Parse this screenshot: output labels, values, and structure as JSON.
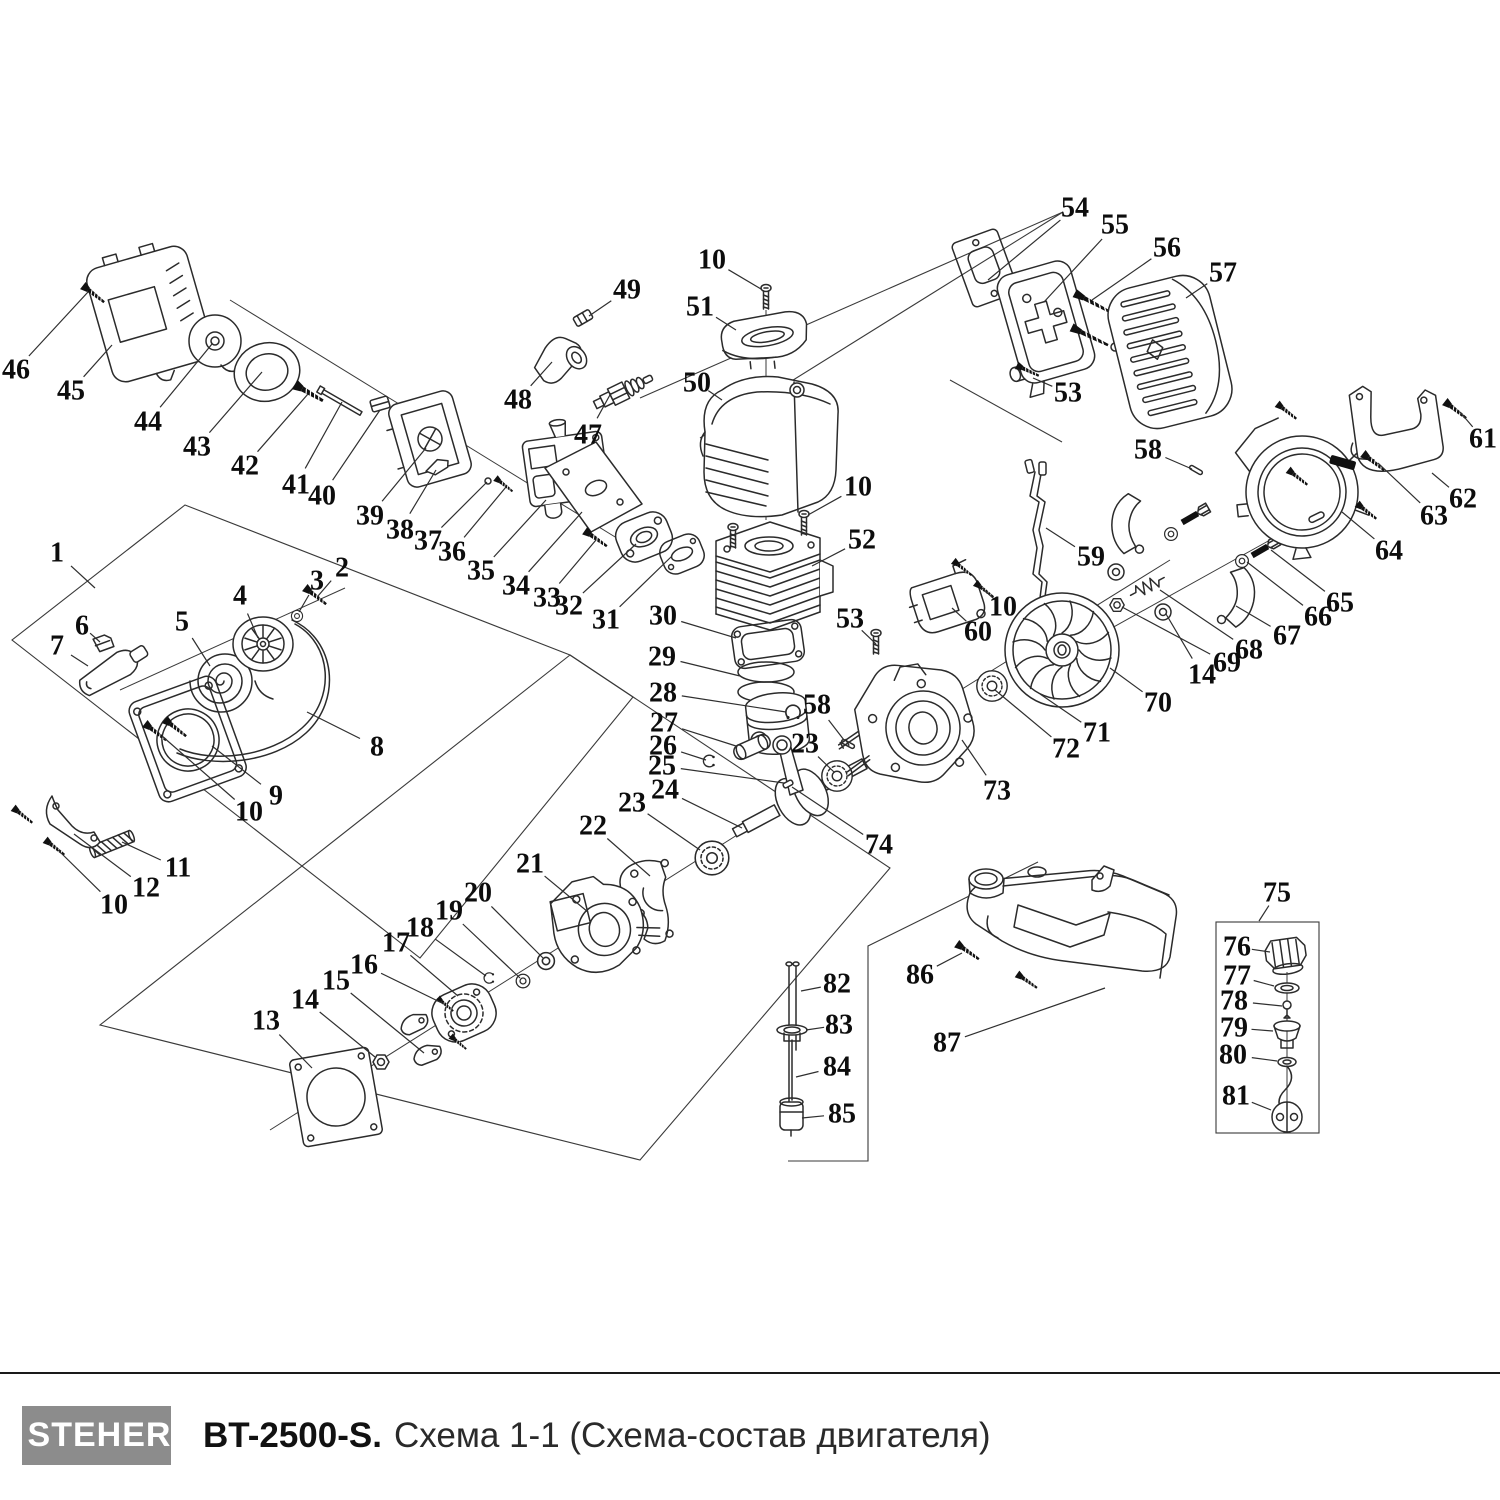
{
  "footer": {
    "brand": "STEHER",
    "model": "BT-2500-S.",
    "subtitle": "Схема 1-1 (Схема-состав двигателя)"
  },
  "colors": {
    "line_art": "#2b2b2b",
    "label_text": "#0d0d0d",
    "logo_background": "#8c8c8c",
    "footer_rule": "#1a1a1a",
    "background": "#ffffff"
  },
  "diagram": {
    "labels": [
      {
        "n": "1",
        "x": 57,
        "y": 553,
        "lx": 95,
        "ly": 588
      },
      {
        "n": "2",
        "x": 342,
        "y": 568,
        "lx": 318,
        "ly": 596
      },
      {
        "n": "3",
        "x": 317,
        "y": 581,
        "lx": 299,
        "ly": 612
      },
      {
        "n": "4",
        "x": 240,
        "y": 596,
        "lx": 258,
        "ly": 638
      },
      {
        "n": "5",
        "x": 182,
        "y": 622,
        "lx": 210,
        "ly": 666
      },
      {
        "n": "6",
        "x": 82,
        "y": 626,
        "lx": 100,
        "ly": 642
      },
      {
        "n": "7",
        "x": 57,
        "y": 646,
        "lx": 88,
        "ly": 666
      },
      {
        "n": "8",
        "x": 377,
        "y": 747,
        "lx": 307,
        "ly": 712
      },
      {
        "n": "9",
        "x": 276,
        "y": 796,
        "lx": 212,
        "ly": 746
      },
      {
        "n": "10",
        "x": 249,
        "y": 812,
        "lx": 162,
        "ly": 736
      },
      {
        "n": "11",
        "x": 178,
        "y": 868,
        "lx": 122,
        "ly": 842
      },
      {
        "n": "12",
        "x": 146,
        "y": 888,
        "lx": 74,
        "ly": 834
      },
      {
        "n": "10",
        "x": 114,
        "y": 905,
        "lx": 58,
        "ly": 850
      },
      {
        "n": "13",
        "x": 266,
        "y": 1021,
        "lx": 312,
        "ly": 1068
      },
      {
        "n": "14",
        "x": 305,
        "y": 1000,
        "lx": 375,
        "ly": 1057
      },
      {
        "n": "15",
        "x": 336,
        "y": 981,
        "lx": 424,
        "ly": 1053
      },
      {
        "n": "16",
        "x": 364,
        "y": 965,
        "lx": 444,
        "ly": 1004
      },
      {
        "n": "17",
        "x": 396,
        "y": 943,
        "lx": 458,
        "ly": 996
      },
      {
        "n": "18",
        "x": 420,
        "y": 928,
        "lx": 486,
        "ly": 976
      },
      {
        "n": "19",
        "x": 449,
        "y": 911,
        "lx": 520,
        "ly": 978
      },
      {
        "n": "20",
        "x": 478,
        "y": 893,
        "lx": 543,
        "ly": 958
      },
      {
        "n": "21",
        "x": 530,
        "y": 864,
        "lx": 588,
        "ly": 912
      },
      {
        "n": "22",
        "x": 593,
        "y": 826,
        "lx": 650,
        "ly": 876
      },
      {
        "n": "23",
        "x": 632,
        "y": 803,
        "lx": 700,
        "ly": 850
      },
      {
        "n": "24",
        "x": 665,
        "y": 790,
        "lx": 742,
        "ly": 828
      },
      {
        "n": "25",
        "x": 662,
        "y": 766,
        "lx": 784,
        "ly": 783
      },
      {
        "n": "26",
        "x": 663,
        "y": 746,
        "lx": 706,
        "ly": 760
      },
      {
        "n": "27",
        "x": 664,
        "y": 723,
        "lx": 736,
        "ly": 746
      },
      {
        "n": "28",
        "x": 663,
        "y": 693,
        "lx": 786,
        "ly": 712
      },
      {
        "n": "29",
        "x": 662,
        "y": 657,
        "lx": 740,
        "ly": 676
      },
      {
        "n": "30",
        "x": 663,
        "y": 616,
        "lx": 736,
        "ly": 638
      },
      {
        "n": "31",
        "x": 606,
        "y": 620,
        "lx": 672,
        "ly": 556
      },
      {
        "n": "32",
        "x": 569,
        "y": 606,
        "lx": 636,
        "ly": 544
      },
      {
        "n": "33",
        "x": 547,
        "y": 598,
        "lx": 596,
        "ly": 540
      },
      {
        "n": "34",
        "x": 516,
        "y": 586,
        "lx": 582,
        "ly": 512
      },
      {
        "n": "35",
        "x": 481,
        "y": 571,
        "lx": 546,
        "ly": 500
      },
      {
        "n": "36",
        "x": 452,
        "y": 552,
        "lx": 506,
        "ly": 487
      },
      {
        "n": "37",
        "x": 428,
        "y": 541,
        "lx": 487,
        "ly": 482
      },
      {
        "n": "38",
        "x": 400,
        "y": 530,
        "lx": 436,
        "ly": 470
      },
      {
        "n": "39",
        "x": 370,
        "y": 516,
        "lx": 426,
        "ly": 448
      },
      {
        "n": "40",
        "x": 322,
        "y": 496,
        "lx": 380,
        "ly": 410
      },
      {
        "n": "41",
        "x": 296,
        "y": 485,
        "lx": 342,
        "ly": 402
      },
      {
        "n": "42",
        "x": 245,
        "y": 466,
        "lx": 308,
        "ly": 394
      },
      {
        "n": "43",
        "x": 197,
        "y": 447,
        "lx": 262,
        "ly": 372
      },
      {
        "n": "44",
        "x": 148,
        "y": 422,
        "lx": 212,
        "ly": 344
      },
      {
        "n": "45",
        "x": 71,
        "y": 391,
        "lx": 112,
        "ly": 345
      },
      {
        "n": "46",
        "x": 16,
        "y": 370,
        "lx": 88,
        "ly": 292
      },
      {
        "n": "47",
        "x": 588,
        "y": 435,
        "lx": 611,
        "ly": 393
      },
      {
        "n": "48",
        "x": 518,
        "y": 400,
        "lx": 552,
        "ly": 362
      },
      {
        "n": "49",
        "x": 627,
        "y": 290,
        "lx": 589,
        "ly": 316
      },
      {
        "n": "50",
        "x": 697,
        "y": 383,
        "lx": 722,
        "ly": 400
      },
      {
        "n": "51",
        "x": 700,
        "y": 307,
        "lx": 736,
        "ly": 330
      },
      {
        "n": "10",
        "x": 712,
        "y": 260,
        "lx": 761,
        "ly": 289
      },
      {
        "n": "10",
        "x": 858,
        "y": 487,
        "lx": 808,
        "ly": 515
      },
      {
        "n": "52",
        "x": 862,
        "y": 540,
        "lx": 812,
        "ly": 566
      },
      {
        "n": "53",
        "x": 850,
        "y": 619,
        "lx": 876,
        "ly": 644
      },
      {
        "n": "53",
        "x": 1068,
        "y": 393,
        "lx": 1033,
        "ly": 378
      },
      {
        "n": "54",
        "x": 1075,
        "y": 208,
        "lx": 988,
        "ly": 280
      },
      {
        "n": "55",
        "x": 1115,
        "y": 225,
        "lx": 1044,
        "ly": 302
      },
      {
        "n": "56",
        "x": 1167,
        "y": 248,
        "lx": 1092,
        "ly": 300
      },
      {
        "n": "57",
        "x": 1223,
        "y": 273,
        "lx": 1186,
        "ly": 298
      },
      {
        "n": "58",
        "x": 1148,
        "y": 450,
        "lx": 1192,
        "ly": 469
      },
      {
        "n": "58",
        "x": 817,
        "y": 705,
        "lx": 844,
        "ly": 740
      },
      {
        "n": "59",
        "x": 1091,
        "y": 557,
        "lx": 1046,
        "ly": 528
      },
      {
        "n": "60",
        "x": 978,
        "y": 632,
        "lx": 952,
        "ly": 608
      },
      {
        "n": "10",
        "x": 1003,
        "y": 607,
        "lx": 982,
        "ly": 588
      },
      {
        "n": "61",
        "x": 1483,
        "y": 439,
        "lx": 1460,
        "ly": 412
      },
      {
        "n": "62",
        "x": 1463,
        "y": 499,
        "lx": 1432,
        "ly": 473
      },
      {
        "n": "63",
        "x": 1434,
        "y": 516,
        "lx": 1378,
        "ly": 463
      },
      {
        "n": "64",
        "x": 1389,
        "y": 551,
        "lx": 1342,
        "ly": 512
      },
      {
        "n": "65",
        "x": 1340,
        "y": 603,
        "lx": 1271,
        "ly": 550
      },
      {
        "n": "66",
        "x": 1318,
        "y": 617,
        "lx": 1247,
        "ly": 562
      },
      {
        "n": "67",
        "x": 1287,
        "y": 636,
        "lx": 1236,
        "ly": 606
      },
      {
        "n": "68",
        "x": 1249,
        "y": 650,
        "lx": 1160,
        "ly": 590
      },
      {
        "n": "69",
        "x": 1227,
        "y": 663,
        "lx": 1122,
        "ly": 607
      },
      {
        "n": "14",
        "x": 1202,
        "y": 675,
        "lx": 1166,
        "ly": 614
      },
      {
        "n": "70",
        "x": 1158,
        "y": 703,
        "lx": 1110,
        "ly": 668
      },
      {
        "n": "71",
        "x": 1097,
        "y": 733,
        "lx": 1040,
        "ly": 694
      },
      {
        "n": "72",
        "x": 1066,
        "y": 749,
        "lx": 995,
        "ly": 690
      },
      {
        "n": "73",
        "x": 997,
        "y": 791,
        "lx": 962,
        "ly": 740
      },
      {
        "n": "74",
        "x": 879,
        "y": 845,
        "lx": 792,
        "ly": 787
      },
      {
        "n": "23",
        "x": 805,
        "y": 744,
        "lx": 834,
        "ly": 772
      },
      {
        "n": "75",
        "x": 1277,
        "y": 893,
        "lx": 1259,
        "ly": 921
      },
      {
        "n": "76",
        "x": 1237,
        "y": 947,
        "lx": 1270,
        "ly": 952
      },
      {
        "n": "77",
        "x": 1237,
        "y": 976,
        "lx": 1274,
        "ly": 986
      },
      {
        "n": "78",
        "x": 1234,
        "y": 1001,
        "lx": 1282,
        "ly": 1006
      },
      {
        "n": "79",
        "x": 1234,
        "y": 1028,
        "lx": 1273,
        "ly": 1031
      },
      {
        "n": "80",
        "x": 1233,
        "y": 1055,
        "lx": 1277,
        "ly": 1061
      },
      {
        "n": "81",
        "x": 1236,
        "y": 1096,
        "lx": 1271,
        "ly": 1110
      },
      {
        "n": "82",
        "x": 837,
        "y": 984,
        "lx": 801,
        "ly": 991
      },
      {
        "n": "83",
        "x": 839,
        "y": 1025,
        "lx": 806,
        "ly": 1030
      },
      {
        "n": "84",
        "x": 837,
        "y": 1067,
        "lx": 796,
        "ly": 1077
      },
      {
        "n": "85",
        "x": 842,
        "y": 1114,
        "lx": 802,
        "ly": 1118
      },
      {
        "n": "86",
        "x": 920,
        "y": 975,
        "lx": 962,
        "ly": 953
      },
      {
        "n": "87",
        "x": 947,
        "y": 1043,
        "lx": 1105,
        "ly": 988
      }
    ]
  }
}
